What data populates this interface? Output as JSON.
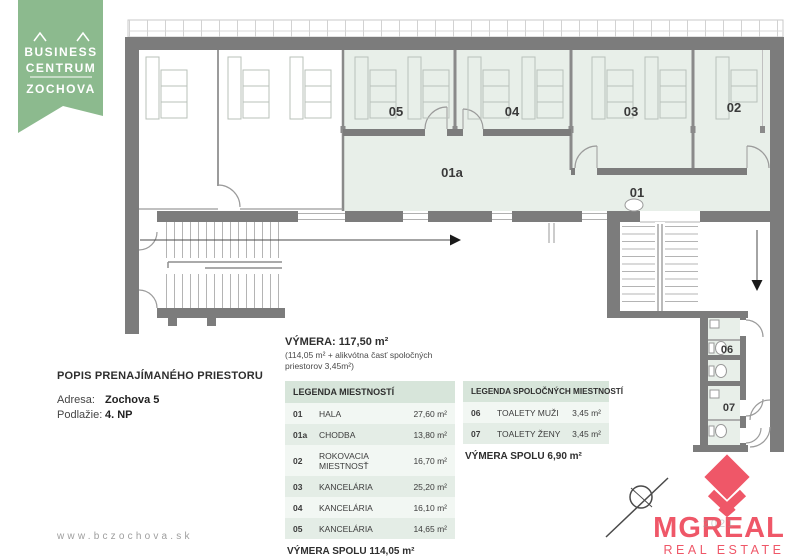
{
  "branding": {
    "line1": "BUSINESS",
    "line2": "CENTRUM",
    "line3": "ZOCHOVA",
    "banner_color": "#8CBA8E",
    "website": "www.bczochova.sk"
  },
  "description": {
    "title": "POPIS PRENAJÍMANÉHO PRIESTORU",
    "address_label": "Adresa:",
    "address_value": "Zochova 5",
    "floor_label": "Podlažie:",
    "floor_value": "4. NP"
  },
  "area_summary": {
    "title": "VÝMERA: 117,50 m²",
    "note_line1": "(114,05 m² + alikvótna časť spoločných",
    "note_line2": "priestorov 3,45m²)"
  },
  "legend_rooms": {
    "title": "LEGENDA MIESTNOSTÍ",
    "rows": [
      {
        "code": "01",
        "name": "HALA",
        "area": "27,60 m²"
      },
      {
        "code": "01a",
        "name": "CHODBA",
        "area": "13,80 m²"
      },
      {
        "code": "02",
        "name": "ROKOVACIA MIESTNOSŤ",
        "area": "16,70 m²"
      },
      {
        "code": "03",
        "name": "KANCELÁRIA",
        "area": "25,20 m²"
      },
      {
        "code": "04",
        "name": "KANCELÁRIA",
        "area": "16,10 m²"
      },
      {
        "code": "05",
        "name": "KANCELÁRIA",
        "area": "14,65 m²"
      }
    ],
    "total": "VÝMERA SPOLU 114,05 m²"
  },
  "legend_common": {
    "title": "LEGENDA SPOLOČNÝCH MIESTNOSTÍ",
    "rows": [
      {
        "code": "06",
        "name": "TOALETY MUŽI",
        "area": "3,45 m²"
      },
      {
        "code": "07",
        "name": "TOALETY ŽENY",
        "area": "3,45 m²"
      }
    ],
    "total": "VÝMERA SPOLU 6,90 m²"
  },
  "floorplan": {
    "fill_color": "#E8EFE9",
    "wall_color": "#7C7C7C",
    "labels": {
      "l01": "01",
      "l01a": "01a",
      "l02": "02",
      "l03": "03",
      "l04": "04",
      "l05": "05",
      "l06": "06",
      "l07": "07"
    }
  },
  "agency": {
    "name": "MGREAL",
    "tagline": "REAL ESTATE",
    "accent_color": "#EF5768",
    "watermark": "2021"
  }
}
